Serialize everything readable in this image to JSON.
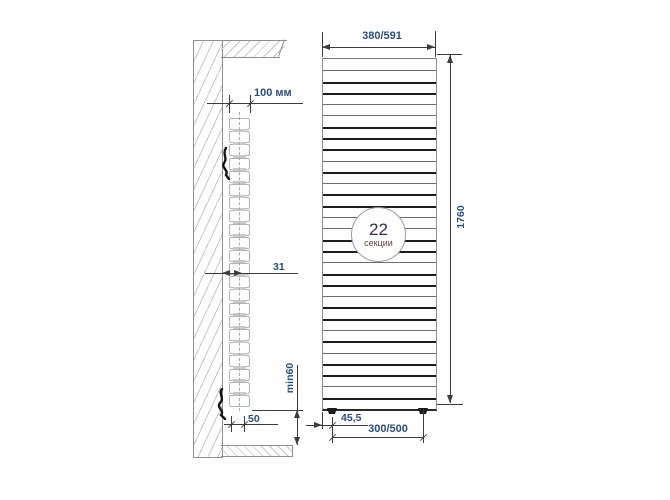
{
  "side_view": {
    "depth_label": "100 мм",
    "wall_gap_label": "31",
    "bracket_label": "50",
    "floor_clearance_label": "min60",
    "sections": 22
  },
  "front_view": {
    "width_label": "380/591",
    "height_label": "1760",
    "foot_offset_label": "45,5",
    "connection_label": "300/500",
    "badge_value": "22",
    "badge_unit": "секции",
    "line_pattern": [
      "n",
      "t",
      "t",
      "n",
      "n",
      "t",
      "t",
      "t",
      "n",
      "t",
      "n",
      "t",
      "t",
      "n",
      "n",
      "t",
      "t",
      "n",
      "t",
      "t",
      "n",
      "t",
      "t",
      "n",
      "t",
      "n",
      "t",
      "t",
      "n",
      "t"
    ]
  },
  "colors": {
    "dim_text": "#2b4e7e",
    "dim_line": "#3c3c3c",
    "line_dark": "#1c1c1c",
    "line_thin": "#6e6e6e",
    "edge": "#8f8f8f",
    "hatch": "#c6c6c6",
    "badge_value": "#28334d",
    "badge_unit": "#6b3d33",
    "section_edge": "#b3b3b3",
    "tab": "#c9c9c9"
  }
}
